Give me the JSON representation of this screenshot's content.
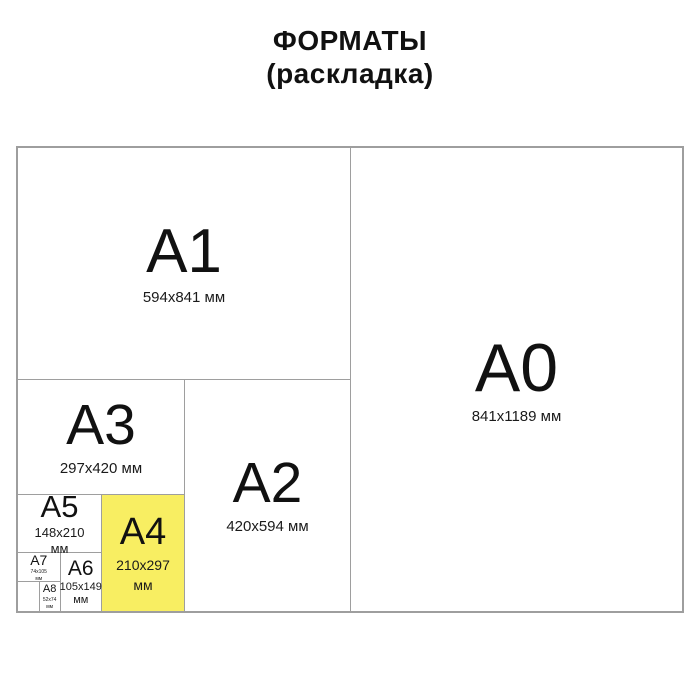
{
  "title": {
    "line1": "ФОРМАТЫ",
    "line2": "(раскладка)"
  },
  "colors": {
    "highlight_yellow": "#F8EE62",
    "line_gray": "#9E9E9E",
    "text_black": "#111111"
  },
  "formats": {
    "a0": {
      "label": "A0",
      "dims": "841x1189 мм",
      "highlighted": false
    },
    "a1": {
      "label": "A1",
      "dims": "594x841 мм",
      "highlighted": false
    },
    "a2": {
      "label": "A2",
      "dims": "420x594 мм",
      "highlighted": false
    },
    "a3": {
      "label": "A3",
      "dims": "297x420 мм",
      "highlighted": false
    },
    "a4": {
      "label": "A4",
      "dims": "210x297",
      "unit": "мм",
      "highlighted": true
    },
    "a5": {
      "label": "A5",
      "dims": "148x210",
      "unit": "мм",
      "highlighted": false
    },
    "a6": {
      "label": "A6",
      "dims": "105x149",
      "unit": "мм",
      "highlighted": false
    },
    "a7": {
      "label": "A7",
      "dims": "74x105",
      "unit": "мм",
      "highlighted": false
    },
    "a8": {
      "label": "A8",
      "dims": "52x74",
      "unit": "мм",
      "highlighted": false
    }
  }
}
